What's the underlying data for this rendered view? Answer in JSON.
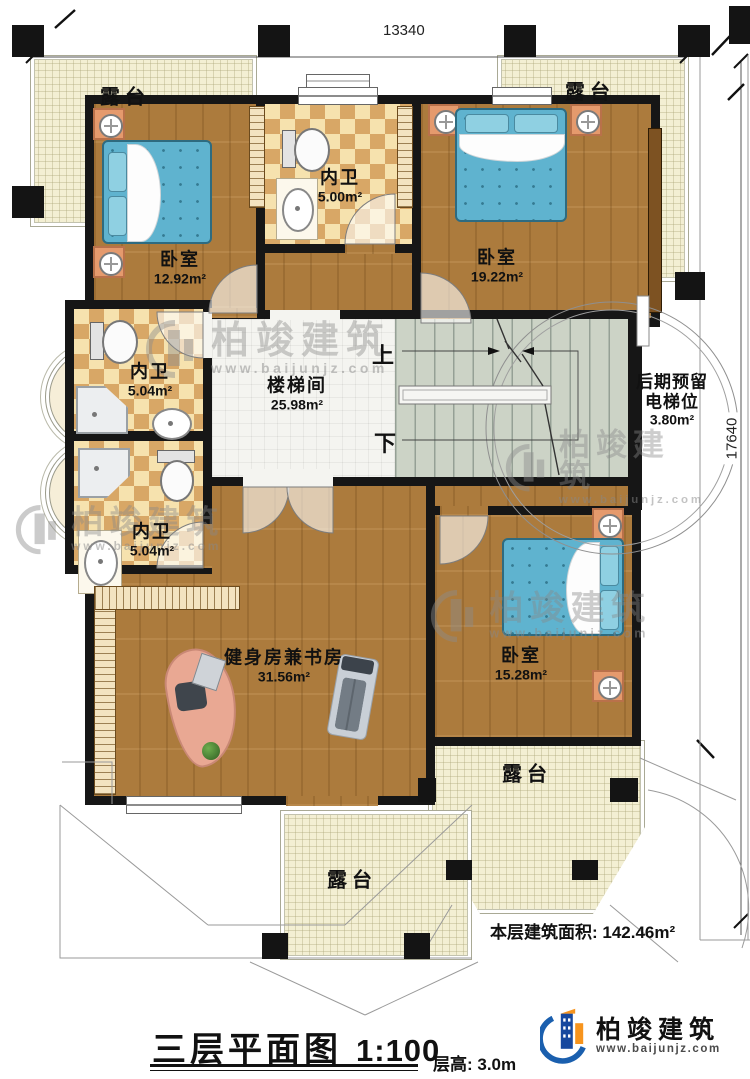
{
  "dimensions": {
    "top": "13340",
    "right": "17640"
  },
  "terraces": {
    "tl": {
      "label": "露台"
    },
    "tr": {
      "label": "露台"
    },
    "br": {
      "label": "露台"
    },
    "bm": {
      "label": "露台"
    }
  },
  "rooms": {
    "bedroom_tl": {
      "name": "卧室",
      "area": "12.92m²"
    },
    "bath_top": {
      "name": "内卫",
      "area": "5.00m²"
    },
    "bedroom_tr": {
      "name": "卧室",
      "area": "19.22m²"
    },
    "bath_mid": {
      "name": "内卫",
      "area": "5.04m²"
    },
    "stairwell": {
      "name": "楼梯间",
      "area": "25.98m²"
    },
    "elevator": {
      "line1": "后期预留",
      "line2": "电梯位",
      "area": "3.80m²"
    },
    "bath_low": {
      "name": "内卫",
      "area": "5.04m²"
    },
    "gym": {
      "name": "健身房兼书房",
      "area": "31.56m²"
    },
    "bedroom_b": {
      "name": "卧室",
      "area": "15.28m²"
    }
  },
  "stairs": {
    "up": "上",
    "down": "下"
  },
  "watermark": {
    "brand": "柏竣建筑",
    "site": "www.baijunjz.com"
  },
  "footer": {
    "area_text": "本层建筑面积: 142.46m²",
    "title": "三层平面图",
    "scale": "1:100",
    "floor_height": "层高: 3.0m"
  },
  "logo": {
    "brand": "柏竣建筑",
    "site": "www.baijunjz.com"
  },
  "colors": {
    "accent_blue": "#1a5fae",
    "accent_orange": "#f7941d",
    "wall": "#161616"
  }
}
